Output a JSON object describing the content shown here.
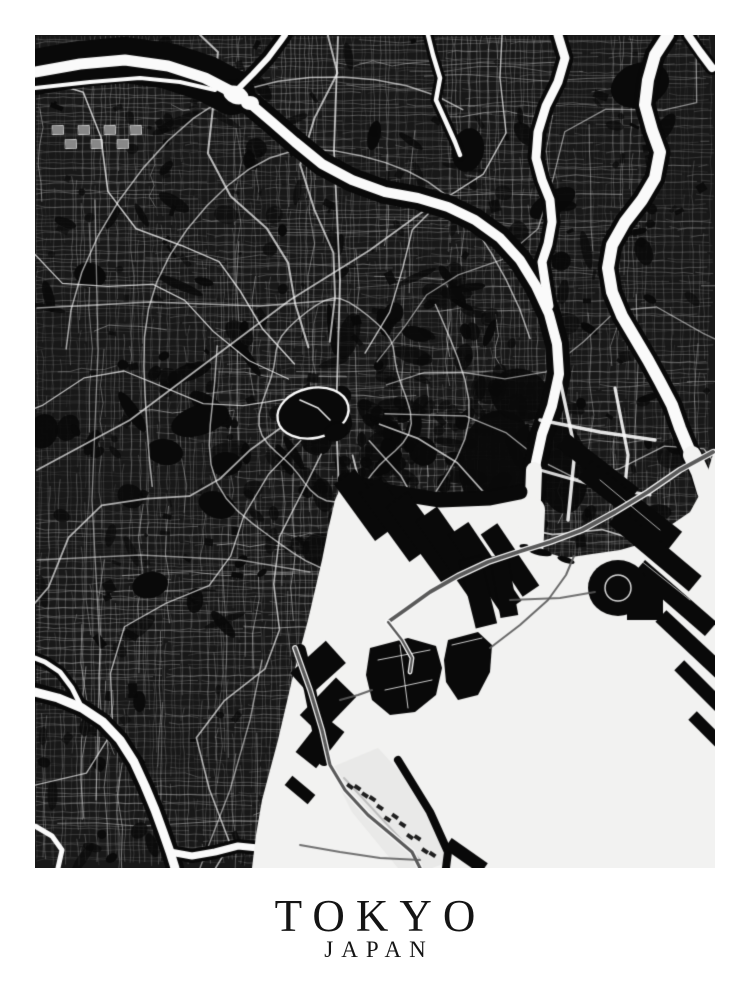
{
  "poster": {
    "title": "TOKYO",
    "subtitle": "JAPAN",
    "description": "Black and white street map poster of Tokyo, Japan, with Tokyo Bay in the lower right"
  },
  "map": {
    "colors": {
      "paper": "#ffffff",
      "land": "#181818",
      "ink": "#090909",
      "street": "#e9e9e9",
      "major_street": "#f2f2f2",
      "river": "#fafafa",
      "water": "#f2f2f1",
      "highway": "#5a5a5a",
      "text": "#141414"
    }
  }
}
